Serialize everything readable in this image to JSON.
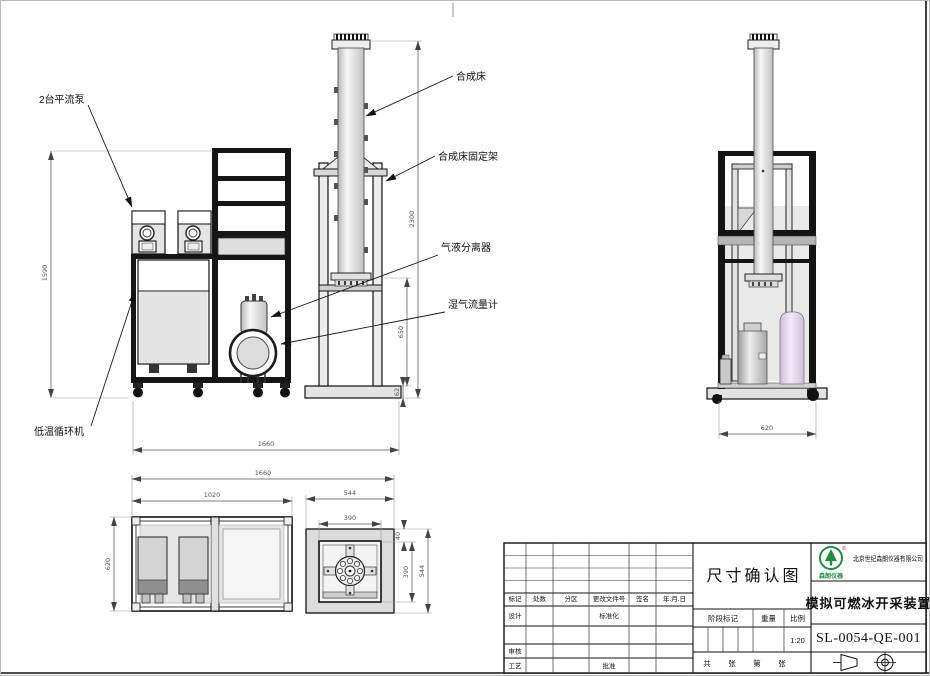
{
  "annotations": {
    "pumps": "2台平流泵",
    "synthesis_bed": "合成床",
    "bed_frame": "合成床固定架",
    "gas_liquid_separator": "气液分离器",
    "wet_gas_flow_meter": "湿气流量计",
    "low_temp_circulator": "低温循环机"
  },
  "dimensions": {
    "front_height": "1590",
    "column_height": "2300",
    "stand_height": "650",
    "base_height": "62",
    "front_width": "1660",
    "side_width": "620",
    "plan_total_width": "1660",
    "plan_cart_width": "1020",
    "plan_stand_width": "544",
    "plan_inner_width": "390",
    "plan_cart_depth": "620",
    "plan_offset": "40",
    "plan_inner_depth": "390",
    "plan_stand_depth": "544"
  },
  "title_block": {
    "sheet_name": "尺寸确认图",
    "product_name": "模拟可燃冰开采装置",
    "drawing_no": "SL-0054-QE-001",
    "company": "北京世纪森朗仪器有限公司",
    "logo_text": "森朗仪器",
    "logo_reg": "®",
    "rev_headers": [
      "标记",
      "处数",
      "分区",
      "更改文件号",
      "签名",
      "年.月.日"
    ],
    "sig_design": "设计",
    "sig_standard": "标准化",
    "sig_review": "审核",
    "sig_process": "工艺",
    "sig_approve": "批准",
    "stage_mark": "阶段标记",
    "weight": "重量",
    "scale_label": "比例",
    "scale_value": "1:20",
    "sheets_total_label": "共",
    "sheets_unit1": "张",
    "sheets_no_label": "第",
    "sheets_unit2": "张"
  }
}
